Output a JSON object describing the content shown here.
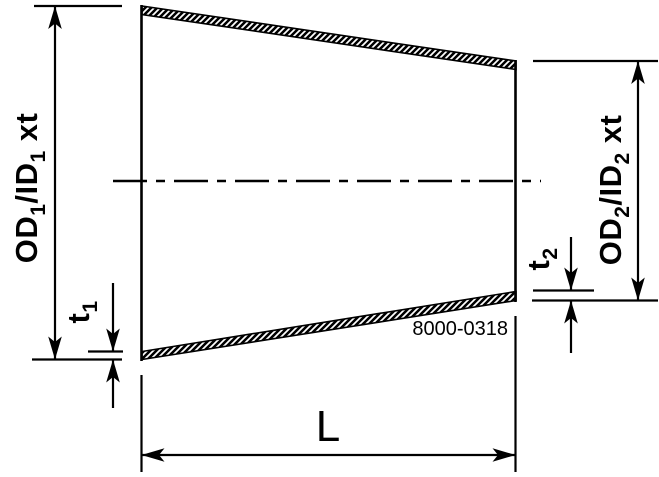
{
  "colors": {
    "line": "#000000",
    "background": "#ffffff"
  },
  "drawing": {
    "dim_od1": {
      "part1": "OD",
      "sub1": "1",
      "part2": "/ID",
      "sub2": "1",
      "part3": "xt",
      "full_text": "OD1/ID1 xt"
    },
    "dim_od2": {
      "part1": "OD",
      "sub1": "2",
      "part2": "/ID",
      "sub2": "2",
      "part3": "xt",
      "full_text": "OD2/ID2 xt"
    },
    "dim_t1": {
      "base": "t",
      "sub": "1",
      "full_text": "t1"
    },
    "dim_t2": {
      "base": "t",
      "sub": "2",
      "full_text": "t2"
    },
    "dim_length": {
      "label": "L"
    },
    "drawing_number": "8000-0318"
  }
}
